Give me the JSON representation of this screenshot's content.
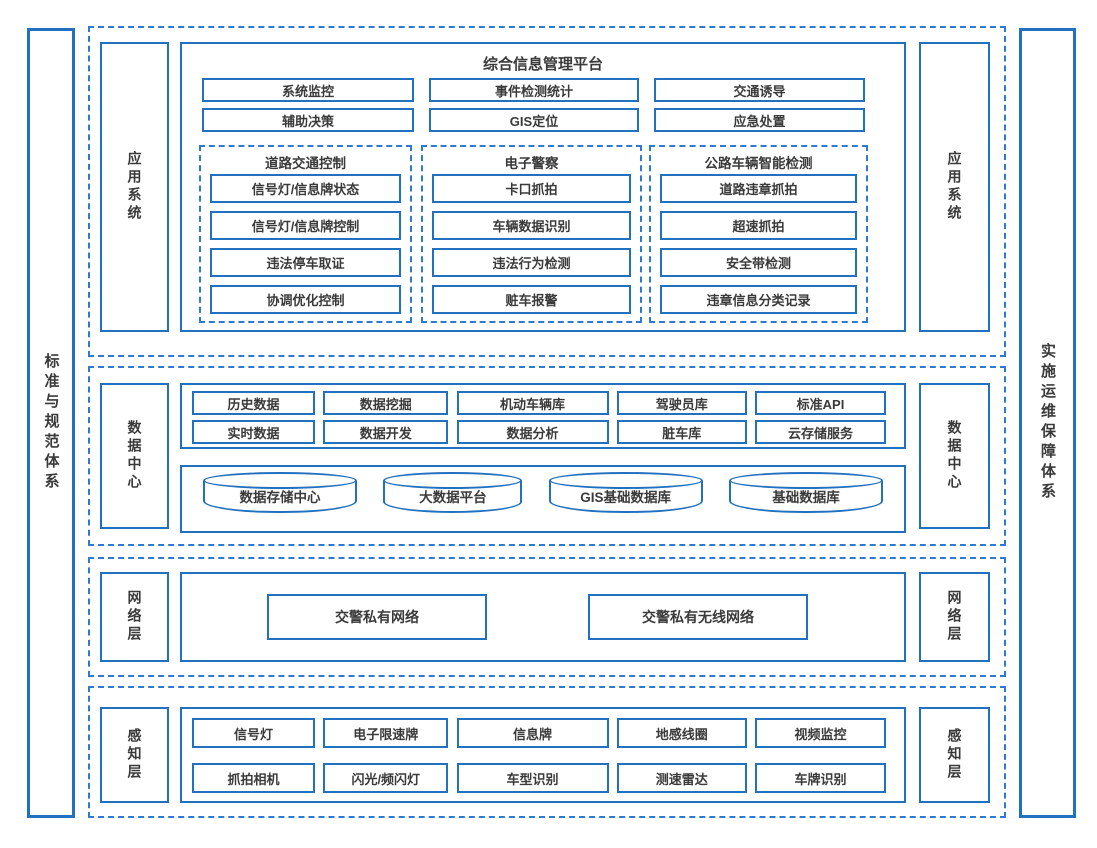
{
  "colors": {
    "solid_line": "#2171c0",
    "dashed_line": "#2e7ad1",
    "text": "#3a3a3a",
    "background": "#ffffff"
  },
  "side_bars": {
    "left": "标准与规范体系",
    "right": "实施运维保障体系"
  },
  "layers": {
    "app": {
      "label": "应用系统",
      "platform_title": "综合信息管理平台",
      "button_rows": [
        [
          "系统监控",
          "事件检测统计",
          "交通诱导"
        ],
        [
          "辅助决策",
          "GIS定位",
          "应急处置"
        ]
      ],
      "groups": [
        {
          "title": "道路交通控制",
          "items": [
            "信号灯/信息牌状态",
            "信号灯/信息牌控制",
            "违法停车取证",
            "协调优化控制"
          ]
        },
        {
          "title": "电子警察",
          "items": [
            "卡口抓拍",
            "车辆数据识别",
            "违法行为检测",
            "赃车报警"
          ]
        },
        {
          "title": "公路车辆智能检测",
          "items": [
            "道路违章抓拍",
            "超速抓拍",
            "安全带检测",
            "违章信息分类记录"
          ]
        }
      ]
    },
    "data_center": {
      "label": "数据中心",
      "field_rows": [
        [
          "历史数据",
          "数据挖掘",
          "机动车辆库",
          "驾驶员库",
          "标准API"
        ],
        [
          "实时数据",
          "数据开发",
          "数据分析",
          "脏车库",
          "云存储服务"
        ]
      ],
      "databases": [
        "数据存储中心",
        "大数据平台",
        "GIS基础数据库",
        "基础数据库"
      ]
    },
    "network": {
      "label": "网络层",
      "items": [
        "交警私有网络",
        "交警私有无线网络"
      ]
    },
    "perception": {
      "label": "感知层",
      "rows": [
        [
          "信号灯",
          "电子限速牌",
          "信息牌",
          "地感线圈",
          "视频监控"
        ],
        [
          "抓拍相机",
          "闪光/频闪灯",
          "车型识别",
          "测速雷达",
          "车牌识别"
        ]
      ]
    }
  }
}
